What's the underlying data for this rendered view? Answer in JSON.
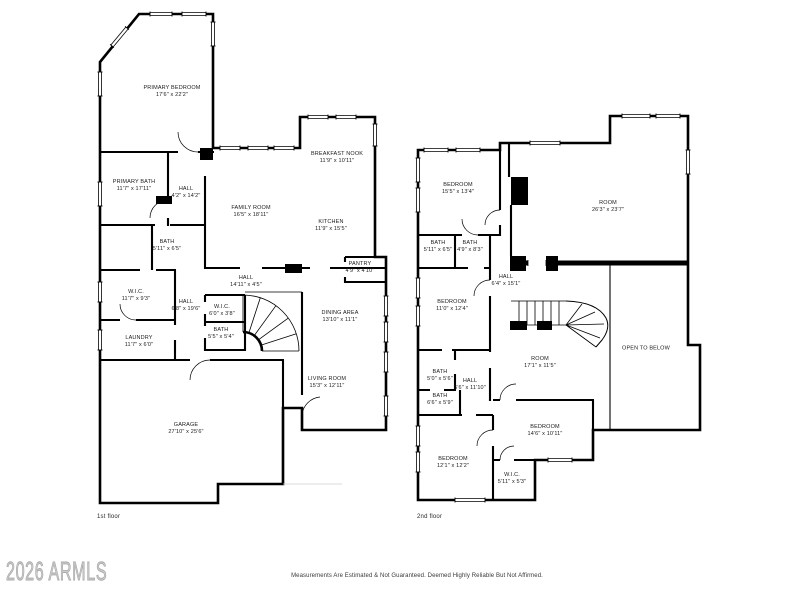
{
  "watermark": "2026 ARMLS",
  "disclaimer": "Measurements Are Estimated & Not Guaranteed. Deemed Highly Reliable But Not Affirmed.",
  "colors": {
    "wall": "#000000",
    "background": "#ffffff",
    "watermark": "#cdcdcd",
    "label_text": "#1b1b1b"
  },
  "floors": [
    {
      "label": "1st floor",
      "label_x": 97,
      "label_y": 514,
      "rooms": [
        {
          "name": "PRIMARY BEDROOM",
          "dims": "17'6\" x 22'2\"",
          "x": 172,
          "y": 92
        },
        {
          "name": "PRIMARY BATH",
          "dims": "11'7\" x 17'11\"",
          "x": 134,
          "y": 186
        },
        {
          "name": "HALL",
          "dims": "4'2\" x 14'2\"",
          "x": 186,
          "y": 193
        },
        {
          "name": "FAMILY ROOM",
          "dims": "16'5\" x 18'11\"",
          "x": 251,
          "y": 212
        },
        {
          "name": "BREAKFAST NOOK",
          "dims": "11'9\" x 10'11\"",
          "x": 337,
          "y": 158
        },
        {
          "name": "KITCHEN",
          "dims": "11'9\" x 15'5\"",
          "x": 331,
          "y": 226
        },
        {
          "name": "PANTRY",
          "dims": "4'9\" x 4'10\"",
          "x": 360,
          "y": 268
        },
        {
          "name": "BATH",
          "dims": "5'11\" x 6'5\"",
          "x": 167,
          "y": 246
        },
        {
          "name": "W.I.C.",
          "dims": "11'7\" x 9'3\"",
          "x": 136,
          "y": 296
        },
        {
          "name": "HALL",
          "dims": "14'11\" x 4'5\"",
          "x": 246,
          "y": 282
        },
        {
          "name": "HALL",
          "dims": "6'8\" x 19'6\"",
          "x": 186,
          "y": 306
        },
        {
          "name": "W.I.C.",
          "dims": "6'0\" x 3'8\"",
          "x": 222,
          "y": 311
        },
        {
          "name": "BATH",
          "dims": "5'5\" x 5'4\"",
          "x": 221,
          "y": 334
        },
        {
          "name": "LAUNDRY",
          "dims": "11'7\" x 6'0\"",
          "x": 139,
          "y": 342
        },
        {
          "name": "DINING AREA",
          "dims": "13'10\" x 11'1\"",
          "x": 340,
          "y": 317
        },
        {
          "name": "LIVING ROOM",
          "dims": "15'3\" x 12'11\"",
          "x": 327,
          "y": 383
        },
        {
          "name": "GARAGE",
          "dims": "27'10\" x 25'6\"",
          "x": 186,
          "y": 429
        }
      ]
    },
    {
      "label": "2nd floor",
      "label_x": 417,
      "label_y": 514,
      "rooms": [
        {
          "name": "BEDROOM",
          "dims": "15'5\" x 13'4\"",
          "x": 458,
          "y": 189
        },
        {
          "name": "ROOM",
          "dims": "26'3\" x 23'7\"",
          "x": 608,
          "y": 207
        },
        {
          "name": "BATH",
          "dims": "5'11\" x 6'5\"",
          "x": 438,
          "y": 247
        },
        {
          "name": "BATH",
          "dims": "4'9\" x 8'3\"",
          "x": 470,
          "y": 247
        },
        {
          "name": "HALL",
          "dims": "6'4\" x 15'1\"",
          "x": 506,
          "y": 281
        },
        {
          "name": "BEDROOM",
          "dims": "11'0\" x 12'4\"",
          "x": 452,
          "y": 306
        },
        {
          "name": "ROOM",
          "dims": "17'1\" x 11'5\"",
          "x": 540,
          "y": 363
        },
        {
          "name": "OPEN TO BELOW",
          "dims": "",
          "x": 646,
          "y": 349
        },
        {
          "name": "BATH",
          "dims": "5'0\" x 5'6\"",
          "x": 440,
          "y": 376
        },
        {
          "name": "HALL",
          "dims": "6'6\" x 11'10\"",
          "x": 470,
          "y": 385
        },
        {
          "name": "BATH",
          "dims": "6'6\" x 5'9\"",
          "x": 440,
          "y": 400
        },
        {
          "name": "BEDROOM",
          "dims": "14'6\" x 10'11\"",
          "x": 545,
          "y": 431
        },
        {
          "name": "BEDROOM",
          "dims": "12'1\" x 12'2\"",
          "x": 453,
          "y": 463
        },
        {
          "name": "W.I.C.",
          "dims": "5'11\" x 5'3\"",
          "x": 512,
          "y": 479
        }
      ]
    }
  ]
}
